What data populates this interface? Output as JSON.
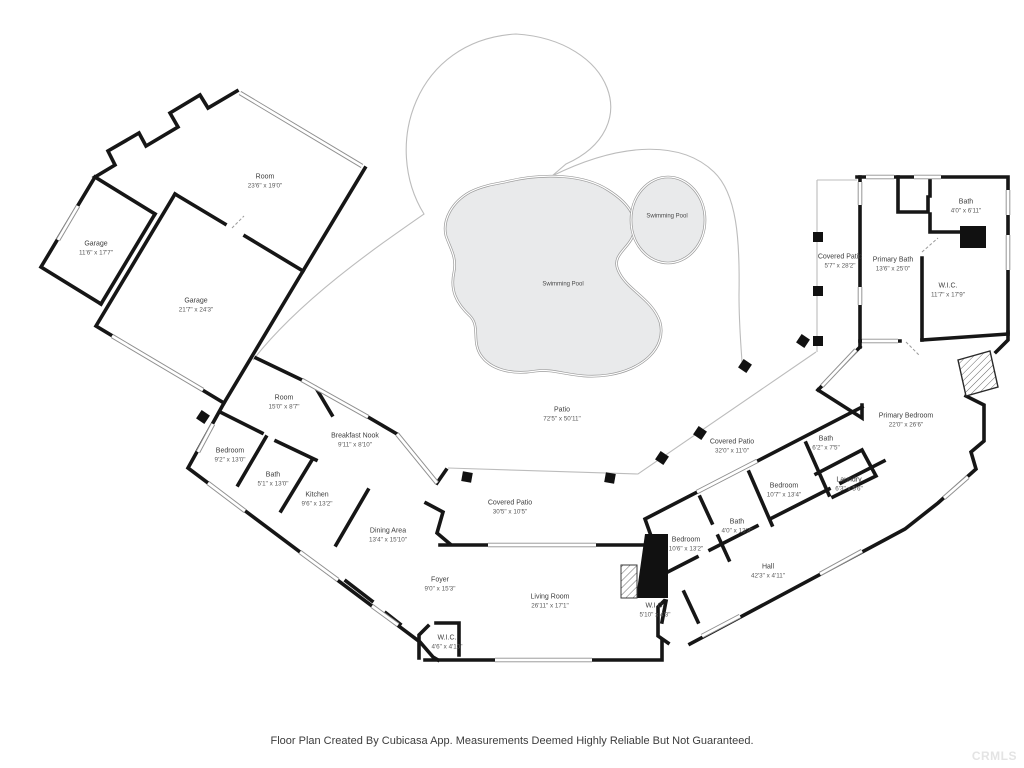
{
  "floorplan": {
    "footer": "Floor Plan Created By Cubicasa App. Measurements Deemed Highly Reliable But Not Guaranteed.",
    "watermark": "CRMLS",
    "colors": {
      "wall": "#161616",
      "pool_fill": "#e9eaeb",
      "pool_stroke": "#9a9a9a",
      "patio_outline": "#bcbcbc",
      "label_text": "#3d3d3d"
    },
    "rooms": [
      {
        "label": "Room",
        "dims": "23'6\" x 19'0\"",
        "x": 265,
        "y": 182
      },
      {
        "label": "Garage",
        "dims": "11'6\" x 17'7\"",
        "x": 96,
        "y": 249
      },
      {
        "label": "Garage",
        "dims": "21'7\" x 24'3\"",
        "x": 196,
        "y": 306
      },
      {
        "label": "Swimming Pool",
        "dims": "",
        "x": 667,
        "y": 217,
        "small": true
      },
      {
        "label": "Swimming Pool",
        "dims": "",
        "x": 563,
        "y": 285,
        "small": true
      },
      {
        "label": "Patio",
        "dims": "72'5\" x 50'11\"",
        "x": 562,
        "y": 415
      },
      {
        "label": "Covered Patio",
        "dims": "5'7\" x 28'2\"",
        "x": 840,
        "y": 262
      },
      {
        "label": "Primary Bath",
        "dims": "13'6\" x 25'0\"",
        "x": 893,
        "y": 265
      },
      {
        "label": "Bath",
        "dims": "4'0\" x 6'11\"",
        "x": 966,
        "y": 207
      },
      {
        "label": "W.I.C.",
        "dims": "11'7\" x 17'9\"",
        "x": 948,
        "y": 291
      },
      {
        "label": "Primary Bedroom",
        "dims": "22'0\" x 26'6\"",
        "x": 906,
        "y": 421
      },
      {
        "label": "Room",
        "dims": "15'0\" x 8'7\"",
        "x": 284,
        "y": 403
      },
      {
        "label": "Breakfast Nook",
        "dims": "9'11\" x 8'10\"",
        "x": 355,
        "y": 441
      },
      {
        "label": "Bedroom",
        "dims": "9'2\" x 13'0\"",
        "x": 230,
        "y": 456
      },
      {
        "label": "Bath",
        "dims": "5'1\" x 13'0\"",
        "x": 273,
        "y": 480
      },
      {
        "label": "Kitchen",
        "dims": "9'6\" x 13'2\"",
        "x": 317,
        "y": 500
      },
      {
        "label": "Dining Area",
        "dims": "13'4\" x 15'10\"",
        "x": 388,
        "y": 536
      },
      {
        "label": "Covered Patio",
        "dims": "30'5\" x 10'5\"",
        "x": 510,
        "y": 508
      },
      {
        "label": "Foyer",
        "dims": "9'0\" x 15'3\"",
        "x": 440,
        "y": 585
      },
      {
        "label": "Living Room",
        "dims": "26'11\" x 17'1\"",
        "x": 550,
        "y": 602
      },
      {
        "label": "W.I.C.",
        "dims": "4'6\" x 4'10\"",
        "x": 447,
        "y": 643
      },
      {
        "label": "Covered Patio",
        "dims": "32'0\" x 11'0\"",
        "x": 732,
        "y": 447
      },
      {
        "label": "Bath",
        "dims": "6'2\" x 7'5\"",
        "x": 826,
        "y": 444
      },
      {
        "label": "Laundry",
        "dims": "6'3\" x 5'6\"",
        "x": 849,
        "y": 485
      },
      {
        "label": "Bedroom",
        "dims": "10'7\" x 13'4\"",
        "x": 784,
        "y": 491
      },
      {
        "label": "Bath",
        "dims": "4'0\" x 13'3\"",
        "x": 737,
        "y": 527
      },
      {
        "label": "Bedroom",
        "dims": "10'6\" x 13'2\"",
        "x": 686,
        "y": 545
      },
      {
        "label": "Hall",
        "dims": "42'3\" x 4'11\"",
        "x": 768,
        "y": 572
      },
      {
        "label": "W.I.C.",
        "dims": "5'10\" x 4'3\"",
        "x": 655,
        "y": 611
      }
    ]
  }
}
